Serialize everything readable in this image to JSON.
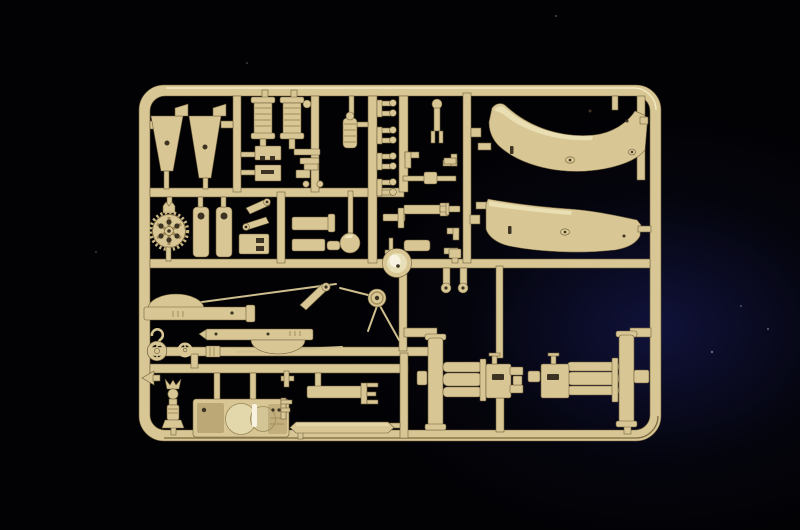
{
  "scene": {
    "type": "product-photo",
    "subject": "Tan injection-molded plastic model kit sprue (parts tree) photographed on a black background with a faint blue glow at right",
    "colors": {
      "bg_base": "#020204",
      "bg_glow": "#10123a",
      "sprue_base": "#d8c794",
      "sprue_light": "#efe4ba",
      "sprue_shadow": "#a58d5c",
      "sprue_outline": "#6f5e3c",
      "shield_light": "#e6dfbd",
      "hole_dark": "#3c3322",
      "highlight_white": "#f8f3e0",
      "rod": "#cfbf8e"
    },
    "parts": [
      {
        "id": "sprue-frame",
        "label": "rounded rectangular sprue frame with internal runners"
      },
      {
        "id": "trail-leg-left",
        "label": "tapered trail leg plate with top tab"
      },
      {
        "id": "trail-leg-right",
        "label": "tapered trail leg plate with top tab"
      },
      {
        "id": "cable-drum-1",
        "label": "ribbed cable drum / spool"
      },
      {
        "id": "cable-drum-2",
        "label": "ribbed cable drum / spool"
      },
      {
        "id": "knob-pin",
        "label": "ball-headed pin"
      },
      {
        "id": "ribbed-cylinder",
        "label": "ribbed cylinder with dome top"
      },
      {
        "id": "spring-clips",
        "label": "four C-shaped spring clips"
      },
      {
        "id": "equipment-boxes",
        "label": "two small notched equipment boxes"
      },
      {
        "id": "mounting-brackets",
        "label": "small mounting bracket strips"
      },
      {
        "id": "spoked-gearwheel",
        "label": "toothed hand wheel with six spokes"
      },
      {
        "id": "trail-spade-left",
        "label": "slab with round eye hole"
      },
      {
        "id": "trail-spade-right",
        "label": "slab with round eye hole"
      },
      {
        "id": "angled-levers",
        "label": "two angled lever links with eye ends"
      },
      {
        "id": "stowage-box",
        "label": "rectangular stowage box"
      },
      {
        "id": "axle-slabs",
        "label": "two flat axle slabs with end caps"
      },
      {
        "id": "shovel",
        "label": "rod with round spade blade"
      },
      {
        "id": "sight-bracket",
        "label": "small sight bracket and tee fitting"
      },
      {
        "id": "road-wheel",
        "label": "round hub wheel with bright highlight"
      },
      {
        "id": "pulley-wheel",
        "label": "small pulley wheel"
      },
      {
        "id": "tow-rods",
        "label": "long thin tow rods and cables"
      },
      {
        "id": "link-arm",
        "label": "short angled link arm with eye"
      },
      {
        "id": "gun-shield-upper",
        "label": "large curved gun shield panel, upper"
      },
      {
        "id": "gun-shield-lower",
        "label": "large curved gun shield panel, lower"
      },
      {
        "id": "barrel-sleeve-upper",
        "label": "bar with half-round hump on top"
      },
      {
        "id": "barrel-sleeve-lower",
        "label": "bar with half-round bulge below"
      },
      {
        "id": "lifting-hook",
        "label": "question-mark shaped lifting hook"
      },
      {
        "id": "handwheel-large",
        "label": "rimmed handwheel"
      },
      {
        "id": "handwheel-small",
        "label": "small four-spoke handwheel"
      },
      {
        "id": "ribbed-coupler",
        "label": "small ribbed coupler block"
      },
      {
        "id": "elevation-column",
        "label": "small horned column part"
      },
      {
        "id": "marker-arrow",
        "label": "left-pointing arrow tab"
      },
      {
        "id": "gun-cradle",
        "label": "large gun cradle block with circular saddles"
      },
      {
        "id": "equilibrator-bar",
        "label": "flat bar with E-shaped end bracket"
      },
      {
        "id": "trail-bar",
        "label": "long bar with pointed ends"
      },
      {
        "id": "recoil-assembly-left",
        "label": "wheel plate with stacked recoil cylinders and forked block"
      },
      {
        "id": "recoil-assembly-right",
        "label": "mirrored wheel plate with stacked recoil cylinders and block"
      },
      {
        "id": "small-fittings",
        "label": "column of small elbow and pin fittings"
      },
      {
        "id": "elbow-fittings",
        "label": "pair of round-flanged elbow fittings"
      }
    ]
  }
}
